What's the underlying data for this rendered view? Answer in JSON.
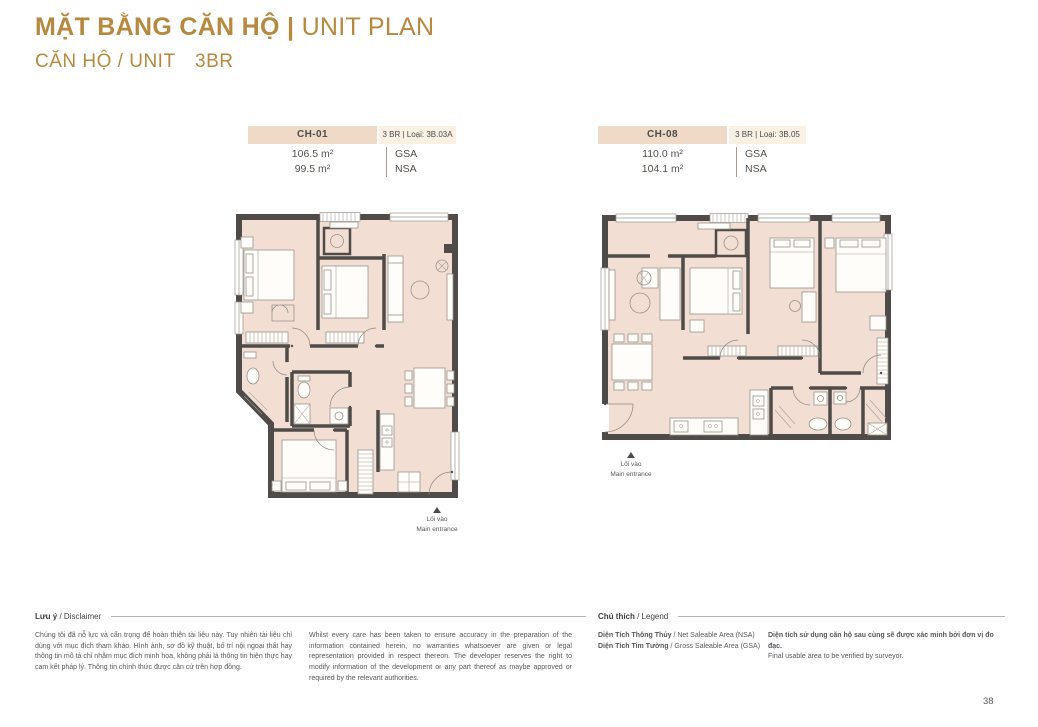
{
  "page": {
    "title_bold": "MẶT BẰNG CĂN HỘ |",
    "title_light": "UNIT PLAN",
    "subtitle_left": "CĂN HỘ / UNIT",
    "subtitle_right": "3BR",
    "page_number": "38"
  },
  "units": [
    {
      "code": "CH-01",
      "type_label": "3 BR | Loại: 3B.03A",
      "gsa_value": "106.5 m²",
      "nsa_value": "99.5 m²",
      "gsa_label": "GSA",
      "nsa_label": "NSA",
      "entrance_vi": "Lối vào",
      "entrance_en": "Main entrance"
    },
    {
      "code": "CH-08",
      "type_label": "3 BR | Loại: 3B.05",
      "gsa_value": "110.0 m²",
      "nsa_value": "104.1 m²",
      "gsa_label": "GSA",
      "nsa_label": "NSA",
      "entrance_vi": "Lối vào",
      "entrance_en": "Main entrance"
    }
  ],
  "disclaimer": {
    "heading_bold": "Lưu ý",
    "heading_rest": " / Disclaimer",
    "text_vi": "Chúng tôi đã nỗ lực và cẩn trọng để hoàn thiện tài liệu này. Tuy nhiên tài liệu chỉ dùng với mục đích tham khảo. Hình ảnh, sơ đồ kỹ thuật, bố trí nội ngoại thất hay thông tin mô tả chỉ nhằm mục đích minh họa, không phải là thông tin hiện thực hay cam kết pháp lý. Thông tin chính thức được căn cứ trên hợp đồng.",
    "text_en": "Whilst every care has been taken to ensure accuracy in the preparation of the information contained herein, no warranties whatsoever are given or legal representation provided in respect thereon. The developer reserves the right to modify information of the development or any part thereof as maybe approved or required by the relevant authorities."
  },
  "legend": {
    "heading_bold": "Chú thích",
    "heading_rest": " / Legend",
    "items": [
      {
        "bold": "Diện Tích Thông Thủy",
        "rest": " / Net Saleable Area (NSA)"
      },
      {
        "bold": "Diện Tích Tim Tường",
        "rest": " / Gross Saleable Area (GSA)"
      }
    ],
    "note_bold": "Diện tích sử dụng căn hộ sau cùng sẽ được xác minh bởi đơn vị đo đạc.",
    "note_rest": "Final usable area to be verified by surveyor."
  },
  "colors": {
    "accent_gold": "#b6893f",
    "plan_fill": "#f2ded3",
    "wall": "#4f4b48",
    "header_cell_bg": "#eedac6",
    "header_type_bg": "#faf1e4",
    "text_gray": "#56575b"
  }
}
